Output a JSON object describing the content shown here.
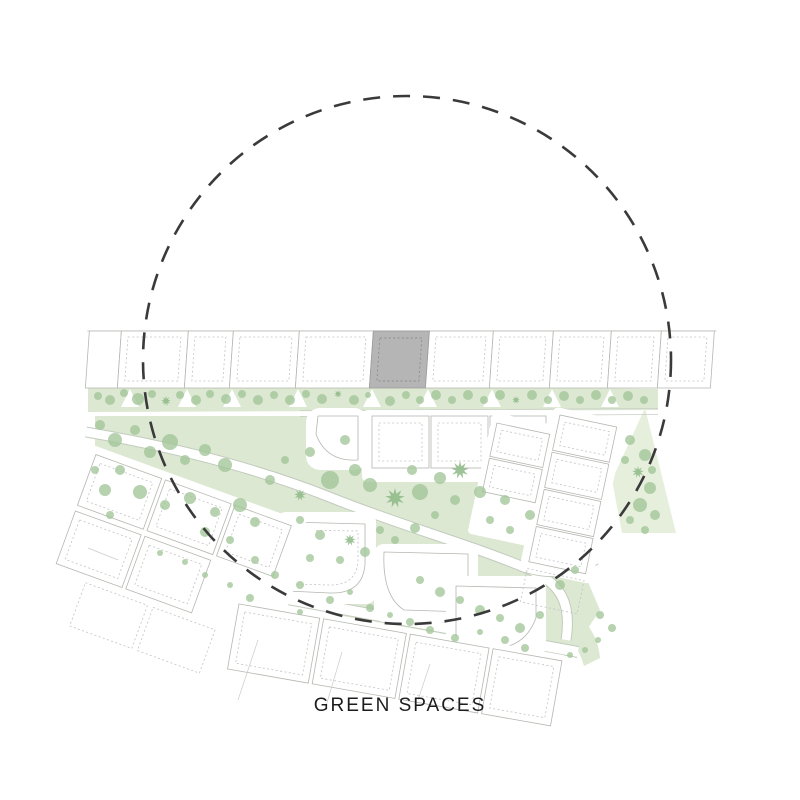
{
  "labels": {
    "title": "GREEN SPACES"
  },
  "colors": {
    "green_area": "#dce8d2",
    "green_area_soft": "#e5efdc",
    "tree": "#a2c599",
    "tree_dark": "#8db986",
    "road_edge": "#c2cbbd",
    "plot_outline": "#b4b8b0",
    "plot_dashed": "#c3c3c3",
    "building_fill": "#b5b5b5",
    "building_dash": "#8f8f8f",
    "circle_stroke": "#3a3a3a",
    "title_color": "#1c1c1c"
  },
  "focus_circle": {
    "cx": 407,
    "cy": 360,
    "r": 264
  },
  "map": {
    "trees": [
      [
        98,
        396,
        4
      ],
      [
        110,
        400,
        5
      ],
      [
        124,
        393,
        4
      ],
      [
        138,
        399,
        6
      ],
      [
        152,
        394,
        4
      ],
      [
        166,
        401,
        5,
        2
      ],
      [
        180,
        395,
        4
      ],
      [
        196,
        400,
        5
      ],
      [
        210,
        394,
        4
      ],
      [
        226,
        399,
        5
      ],
      [
        242,
        394,
        4
      ],
      [
        258,
        400,
        5
      ],
      [
        274,
        395,
        4
      ],
      [
        290,
        400,
        5
      ],
      [
        306,
        394,
        4
      ],
      [
        322,
        399,
        5
      ],
      [
        338,
        394,
        4,
        2
      ],
      [
        354,
        400,
        5
      ],
      [
        368,
        395,
        3
      ],
      [
        390,
        401,
        5
      ],
      [
        406,
        395,
        4
      ],
      [
        420,
        400,
        4
      ],
      [
        436,
        395,
        5
      ],
      [
        452,
        400,
        4
      ],
      [
        468,
        395,
        5
      ],
      [
        484,
        400,
        4
      ],
      [
        500,
        395,
        5
      ],
      [
        516,
        400,
        4,
        2
      ],
      [
        532,
        395,
        5
      ],
      [
        548,
        400,
        4
      ],
      [
        564,
        396,
        5
      ],
      [
        580,
        400,
        4
      ],
      [
        596,
        395,
        5
      ],
      [
        612,
        400,
        4
      ],
      [
        628,
        396,
        5
      ],
      [
        644,
        400,
        4
      ],
      [
        100,
        425,
        5
      ],
      [
        115,
        440,
        7
      ],
      [
        135,
        430,
        5
      ],
      [
        150,
        452,
        6
      ],
      [
        170,
        442,
        8
      ],
      [
        185,
        460,
        5
      ],
      [
        205,
        450,
        6
      ],
      [
        225,
        465,
        7
      ],
      [
        120,
        470,
        5
      ],
      [
        105,
        490,
        6
      ],
      [
        140,
        492,
        7
      ],
      [
        165,
        505,
        5
      ],
      [
        190,
        498,
        6
      ],
      [
        215,
        512,
        5
      ],
      [
        240,
        505,
        7
      ],
      [
        255,
        522,
        5
      ],
      [
        230,
        540,
        4
      ],
      [
        205,
        532,
        5
      ],
      [
        110,
        515,
        4
      ],
      [
        95,
        470,
        4
      ],
      [
        330,
        480,
        9
      ],
      [
        355,
        470,
        6
      ],
      [
        310,
        452,
        5
      ],
      [
        345,
        440,
        5
      ],
      [
        370,
        485,
        7
      ],
      [
        395,
        498,
        10,
        2
      ],
      [
        420,
        492,
        8
      ],
      [
        412,
        470,
        5
      ],
      [
        440,
        478,
        6
      ],
      [
        460,
        470,
        9,
        2
      ],
      [
        455,
        500,
        5
      ],
      [
        480,
        492,
        6
      ],
      [
        505,
        500,
        5
      ],
      [
        300,
        520,
        4
      ],
      [
        320,
        535,
        5
      ],
      [
        350,
        540,
        6,
        2
      ],
      [
        380,
        530,
        4
      ],
      [
        300,
        495,
        6,
        2
      ],
      [
        270,
        480,
        5
      ],
      [
        285,
        460,
        4
      ],
      [
        530,
        515,
        5
      ],
      [
        510,
        530,
        4
      ],
      [
        490,
        520,
        4
      ],
      [
        435,
        515,
        4
      ],
      [
        415,
        528,
        5
      ],
      [
        395,
        540,
        4
      ],
      [
        365,
        552,
        5
      ],
      [
        340,
        560,
        4
      ],
      [
        310,
        558,
        4
      ],
      [
        420,
        580,
        4
      ],
      [
        440,
        592,
        5
      ],
      [
        460,
        600,
        4
      ],
      [
        480,
        610,
        5
      ],
      [
        500,
        618,
        4
      ],
      [
        520,
        628,
        5
      ],
      [
        540,
        615,
        4
      ],
      [
        300,
        585,
        4
      ],
      [
        275,
        575,
        4
      ],
      [
        255,
        560,
        4
      ],
      [
        560,
        585,
        5
      ],
      [
        575,
        570,
        4
      ],
      [
        330,
        600,
        4
      ],
      [
        350,
        592,
        3
      ],
      [
        370,
        608,
        4
      ],
      [
        390,
        615,
        3
      ],
      [
        410,
        622,
        4
      ],
      [
        430,
        630,
        4
      ],
      [
        455,
        638,
        4
      ],
      [
        480,
        632,
        3
      ],
      [
        505,
        640,
        4
      ],
      [
        525,
        648,
        4
      ],
      [
        300,
        612,
        3
      ],
      [
        250,
        598,
        4
      ],
      [
        230,
        585,
        3
      ],
      [
        205,
        575,
        3
      ],
      [
        185,
        562,
        3
      ],
      [
        160,
        553,
        3
      ],
      [
        630,
        440,
        5
      ],
      [
        645,
        455,
        6
      ],
      [
        638,
        472,
        6,
        2
      ],
      [
        650,
        488,
        6
      ],
      [
        640,
        505,
        7
      ],
      [
        655,
        515,
        5
      ],
      [
        630,
        520,
        4
      ],
      [
        645,
        530,
        4
      ],
      [
        625,
        460,
        4
      ],
      [
        652,
        470,
        4
      ],
      [
        600,
        615,
        4
      ],
      [
        612,
        628,
        4
      ],
      [
        598,
        640,
        3
      ],
      [
        585,
        650,
        3
      ],
      [
        570,
        655,
        3
      ]
    ]
  }
}
